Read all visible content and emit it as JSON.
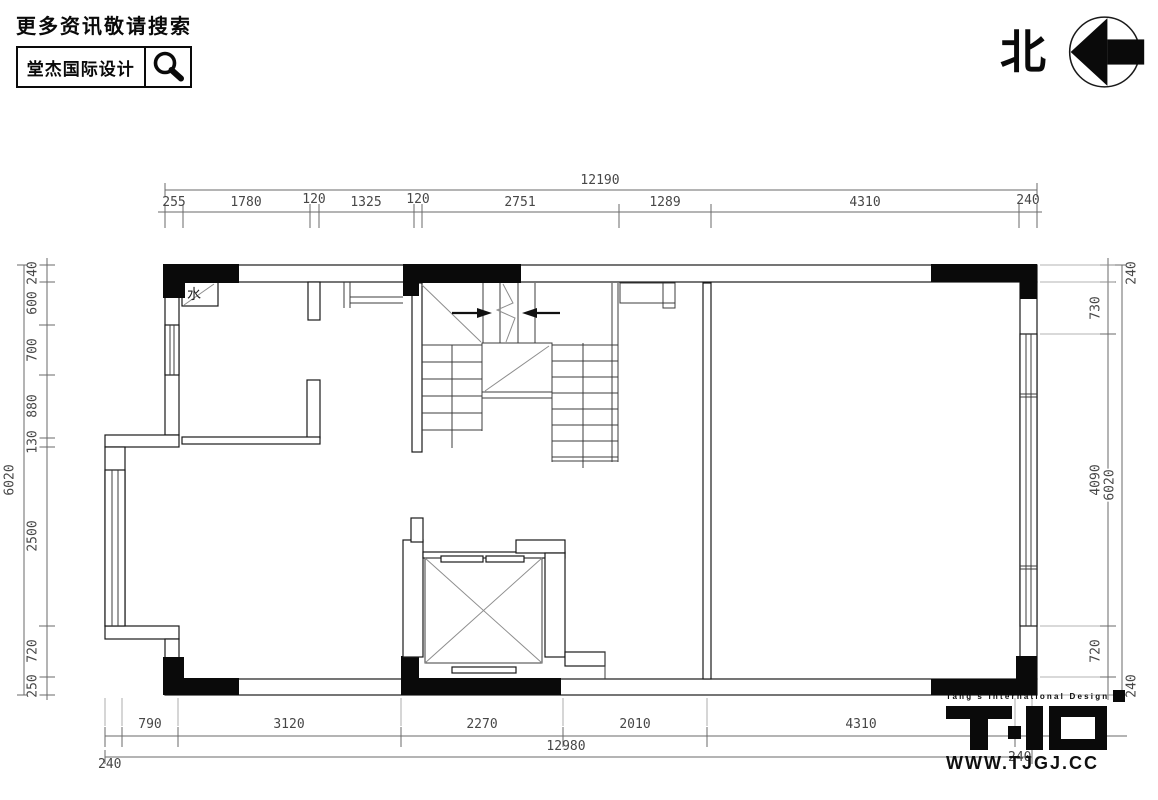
{
  "colors": {
    "ink": "#0a0a0a",
    "wall": "#1a1a1a",
    "dimline": "#6a6a6a",
    "dimtext": "#474747",
    "bg": "#ffffff"
  },
  "header": {
    "search_hint": "更多资讯敬请搜索",
    "brand": "堂杰国际设计",
    "north_label": "北"
  },
  "plan": {
    "water_label": "水"
  },
  "dims": {
    "top": {
      "total": "12190",
      "segments": [
        "255",
        "1780",
        "120",
        "1325",
        "120",
        "2751",
        "1289",
        "4310",
        "240"
      ]
    },
    "bottom": {
      "total": "12980",
      "end_left": "240",
      "end_right": "240",
      "segments": [
        "790",
        "3120",
        "2270",
        "2010",
        "4310"
      ]
    },
    "left": {
      "total": "6020",
      "segments": [
        "240",
        "600",
        "700",
        "880",
        "130",
        "2500",
        "720",
        "250"
      ]
    },
    "right": {
      "total": "6020",
      "segments": [
        "240",
        "730",
        "4090",
        "720",
        "240"
      ]
    }
  },
  "footer": {
    "tagline": "Tang's International Design",
    "website": "WWW.TJGJ.CC"
  }
}
